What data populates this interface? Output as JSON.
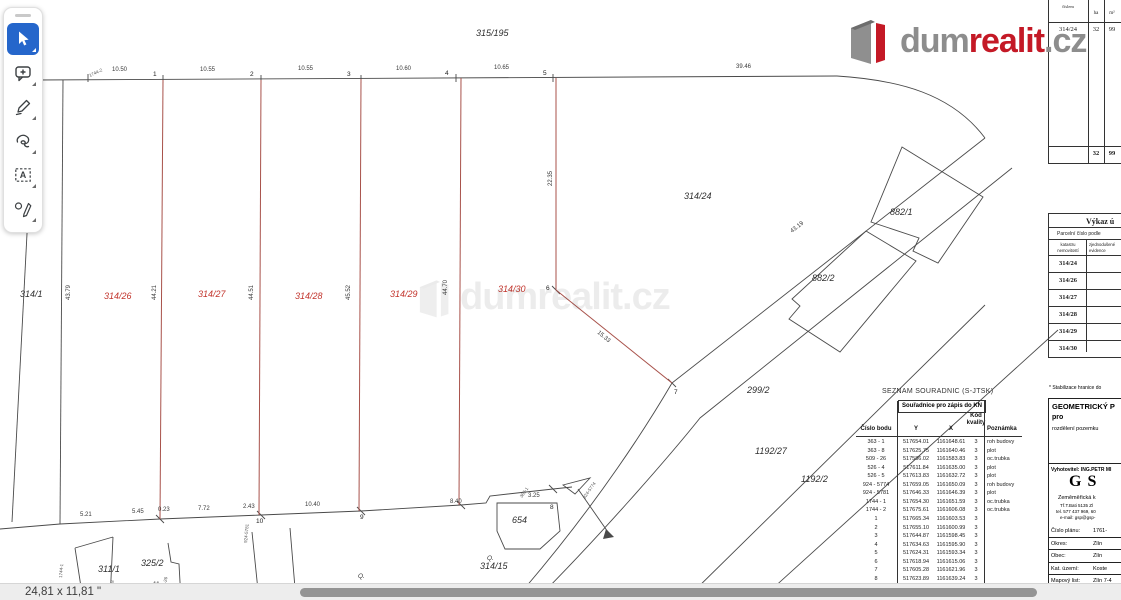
{
  "toolbar": {
    "tools": [
      {
        "name": "select-tool",
        "icon": "cursor-icon",
        "active": true
      },
      {
        "name": "comment-tool",
        "icon": "comment-plus-icon",
        "active": false
      },
      {
        "name": "draw-tool",
        "icon": "pencil-icon",
        "active": false
      },
      {
        "name": "lasso-tool",
        "icon": "lasso-icon",
        "active": false
      },
      {
        "name": "text-box-tool",
        "icon": "text-box-icon",
        "active": false
      },
      {
        "name": "sign-tool",
        "icon": "pen-shapes-icon",
        "active": false
      }
    ]
  },
  "logo": {
    "part1": "dum",
    "part2": "realit",
    "part3": ".cz",
    "gray": "#8d8d8d",
    "red": "#c41926"
  },
  "watermark": {
    "text": "dumrealit.cz"
  },
  "status_bar": {
    "page_size": "24,81 x 11,81 \""
  },
  "area_table": {
    "header": "číslem",
    "col_ha": "ha",
    "col_m2": "m²",
    "row": {
      "parcel": "314/24",
      "ha": "32",
      "m2": "99"
    },
    "total": {
      "ha": "32",
      "m2": "99"
    }
  },
  "vykaz_table": {
    "title": "Výkaz ú",
    "subtitle": "Parcelní číslo podle",
    "col1": [
      "katastru",
      "nemovitostí"
    ],
    "col2": [
      "zjednodušené",
      "evidence"
    ],
    "rows": [
      "314/24",
      "314/26",
      "314/27",
      "314/28",
      "314/29",
      "314/30"
    ]
  },
  "plan_block": {
    "note": "* Stabilizace hranice do",
    "title": "GEOMETRICKÝ P",
    "title2": "pro",
    "subtitle": "rozdělení pozemku",
    "vyhotovitel": "Vyhotovitel: ING.PETR MI",
    "logo": "GS",
    "company": "Zeměměřická k",
    "address": "Tř.T.Bati 5135 Zl",
    "phone": "tel. 577 437 969, 60",
    "email": "e-mail: gsp@gsp-",
    "rows": [
      {
        "label": "Číslo plánu:",
        "value": "1761-"
      },
      {
        "label": "Okres:",
        "value": "Zlín"
      },
      {
        "label": "Obec:",
        "value": "Zlín"
      },
      {
        "label": "Kat. území:",
        "value": "Koste"
      },
      {
        "label": "Mapový list:",
        "value": "Zlín 7-4"
      }
    ],
    "footer": "Dosavadním vlastníkům poze"
  },
  "coord_table": {
    "title": "SEZNAM SOUŘADNIC (S-JTSK)",
    "span_header": "Souřadnice pro zápis do KN",
    "col_point": "Číslo bodu",
    "col_y": "Y",
    "col_x": "X",
    "col_kod": [
      "Kód",
      "kvality"
    ],
    "col_note": "Poznámka",
    "rows": [
      [
        "363 - 1",
        "517654.01",
        "1161648.61",
        "3",
        "roh budovy"
      ],
      [
        "363 - 8",
        "517625.75",
        "1161640.46",
        "3",
        "plot"
      ],
      [
        "509 - 26",
        "517586.02",
        "1161583.83",
        "3",
        "oc.trubka"
      ],
      [
        "526 - 4",
        "517611.84",
        "1161635.00",
        "3",
        "plot"
      ],
      [
        "526 - 5",
        "517613.83",
        "1161632.72",
        "3",
        "plot"
      ],
      [
        "924 - 5774",
        "517659.05",
        "1161650.09",
        "3",
        "roh budovy"
      ],
      [
        "924 - 5781",
        "517646.33",
        "1161646.39",
        "3",
        "plot"
      ],
      [
        "1744 - 1",
        "517654.30",
        "1161651.59",
        "3",
        "oc.trubka"
      ],
      [
        "1744 - 2",
        "517675.61",
        "1161606.08",
        "3",
        "oc.trubka"
      ],
      [
        "1",
        "517665.34",
        "1161603.53",
        "3",
        ""
      ],
      [
        "2",
        "517655.10",
        "1161600.99",
        "3",
        ""
      ],
      [
        "3",
        "517644.87",
        "1161598.45",
        "3",
        ""
      ],
      [
        "4",
        "517634.63",
        "1161595.90",
        "3",
        ""
      ],
      [
        "5",
        "517624.31",
        "1161593.34",
        "3",
        ""
      ],
      [
        "6",
        "517618.94",
        "1161615.06",
        "3",
        ""
      ],
      [
        "7",
        "517605.28",
        "1161621.96",
        "3",
        ""
      ],
      [
        "8",
        "517623.89",
        "1161639.24",
        "3",
        ""
      ],
      [
        "9",
        "517633.87",
        "1161642.79",
        "3",
        ""
      ]
    ]
  },
  "map": {
    "colors": {
      "line": "#4a4a4a",
      "red_line": "#a8514a",
      "red_label": "#c2342c"
    },
    "labels": [
      {
        "t": "315/195",
        "x": 476,
        "y": 36,
        "cls": "pb",
        "n": "parcel-label-315-195"
      },
      {
        "t": "314/1",
        "x": 20,
        "y": 297,
        "cls": "pb",
        "n": "parcel-label-314-1"
      },
      {
        "t": "314/24",
        "x": 684,
        "y": 199,
        "cls": "pb",
        "n": "parcel-label-314-24"
      },
      {
        "t": "882/1",
        "x": 890,
        "y": 215,
        "cls": "pb",
        "n": "parcel-label-882-1"
      },
      {
        "t": "882/2",
        "x": 812,
        "y": 281,
        "cls": "pb",
        "n": "parcel-label-882-2"
      },
      {
        "t": "299/2",
        "x": 747,
        "y": 393,
        "cls": "pb",
        "n": "parcel-label-299-2"
      },
      {
        "t": "1192/27",
        "x": 755,
        "y": 454,
        "cls": "pb",
        "n": "parcel-label-1192-27"
      },
      {
        "t": "1192/2",
        "x": 801,
        "y": 482,
        "cls": "pb",
        "n": "parcel-label-1192-2"
      },
      {
        "t": "654",
        "x": 512,
        "y": 523,
        "cls": "pb",
        "n": "building-label-654"
      },
      {
        "t": "314/15",
        "x": 480,
        "y": 569,
        "cls": "pb",
        "n": "parcel-label-314-15"
      },
      {
        "t": "311/1",
        "x": 98,
        "y": 572,
        "cls": "pb",
        "n": "parcel-label-311-1"
      },
      {
        "t": "325/2",
        "x": 141,
        "y": 566,
        "cls": "pb",
        "n": "parcel-label-325-2"
      },
      {
        "t": "314/26",
        "x": 104,
        "y": 299,
        "cls": "pr",
        "n": "new-parcel-label-314-26"
      },
      {
        "t": "314/27",
        "x": 198,
        "y": 297,
        "cls": "pr",
        "n": "new-parcel-label-314-27"
      },
      {
        "t": "314/28",
        "x": 295,
        "y": 299,
        "cls": "pr",
        "n": "new-parcel-label-314-28"
      },
      {
        "t": "314/29",
        "x": 390,
        "y": 297,
        "cls": "pr",
        "n": "new-parcel-label-314-29"
      },
      {
        "t": "314/30",
        "x": 498,
        "y": 292,
        "cls": "pr",
        "n": "new-parcel-label-314-30"
      },
      {
        "t": "1",
        "x": 153,
        "y": 76,
        "cls": "pt",
        "n": "point-label-1"
      },
      {
        "t": "2",
        "x": 250,
        "y": 76,
        "cls": "pt",
        "n": "point-label-2"
      },
      {
        "t": "3",
        "x": 347,
        "y": 76,
        "cls": "pt",
        "n": "point-label-3"
      },
      {
        "t": "4",
        "x": 445,
        "y": 75,
        "cls": "pt",
        "n": "point-label-4"
      },
      {
        "t": "5",
        "x": 543,
        "y": 75,
        "cls": "pt",
        "n": "point-label-5"
      },
      {
        "t": "6",
        "x": 546,
        "y": 290,
        "cls": "pt",
        "n": "point-label-6"
      },
      {
        "t": "7",
        "x": 674,
        "y": 394,
        "cls": "pt",
        "n": "point-label-7"
      },
      {
        "t": "8",
        "x": 550,
        "y": 509,
        "cls": "pt",
        "n": "point-label-8"
      },
      {
        "t": "9",
        "x": 360,
        "y": 519,
        "cls": "pt",
        "n": "point-label-9"
      },
      {
        "t": "10",
        "x": 256,
        "y": 523,
        "cls": "pt",
        "n": "point-label-10"
      },
      {
        "t": "11",
        "x": 153,
        "y": 586,
        "cls": "pt",
        "n": "point-label-11"
      },
      {
        "t": "10.50",
        "x": 112,
        "y": 71,
        "cls": "dm",
        "n": "dimension-label"
      },
      {
        "t": "10.55",
        "x": 200,
        "y": 71,
        "cls": "dm",
        "n": "dimension-label"
      },
      {
        "t": "10.55",
        "x": 298,
        "y": 70,
        "cls": "dm",
        "n": "dimension-label"
      },
      {
        "t": "10.60",
        "x": 396,
        "y": 70,
        "cls": "dm",
        "n": "dimension-label"
      },
      {
        "t": "10.65",
        "x": 494,
        "y": 69,
        "cls": "dm",
        "n": "dimension-label"
      },
      {
        "t": "39.46",
        "x": 736,
        "y": 68,
        "cls": "dm",
        "n": "dimension-label"
      },
      {
        "t": "5.21",
        "x": 80,
        "y": 516,
        "cls": "dm",
        "n": "dimension-label"
      },
      {
        "t": "5.45",
        "x": 132,
        "y": 513,
        "cls": "dm",
        "n": "dimension-label"
      },
      {
        "t": "0.23",
        "x": 158,
        "y": 511,
        "cls": "dm",
        "n": "dimension-label"
      },
      {
        "t": "7.72",
        "x": 198,
        "y": 510,
        "cls": "dm",
        "n": "dimension-label"
      },
      {
        "t": "2.43",
        "x": 243,
        "y": 508,
        "cls": "dm",
        "n": "dimension-label"
      },
      {
        "t": "10.40",
        "x": 305,
        "y": 506,
        "cls": "dm",
        "n": "dimension-label"
      },
      {
        "t": "8.40",
        "x": 450,
        "y": 503,
        "cls": "dm",
        "n": "dimension-label"
      },
      {
        "t": "3.25",
        "x": 528,
        "y": 497,
        "cls": "dm",
        "n": "dimension-label"
      },
      {
        "t": "43.79",
        "x": 70,
        "y": 300,
        "r": -90,
        "cls": "dm",
        "n": "dimension-label"
      },
      {
        "t": "44.21",
        "x": 156,
        "y": 300,
        "r": -90,
        "cls": "dm",
        "n": "dimension-label"
      },
      {
        "t": "44.51",
        "x": 253,
        "y": 300,
        "r": -90,
        "cls": "dm",
        "n": "dimension-label"
      },
      {
        "t": "45.52",
        "x": 350,
        "y": 300,
        "r": -90,
        "cls": "dm",
        "n": "dimension-label"
      },
      {
        "t": "44.70",
        "x": 447,
        "y": 295,
        "r": -90,
        "cls": "dm",
        "n": "dimension-label"
      },
      {
        "t": "22.35",
        "x": 552,
        "y": 186,
        "r": -90,
        "cls": "dm",
        "n": "dimension-label"
      },
      {
        "t": "15.33",
        "x": 597,
        "y": 333,
        "r": 40,
        "cls": "dm",
        "n": "dimension-label"
      },
      {
        "t": "43.19",
        "x": 792,
        "y": 233,
        "r": -38,
        "cls": "dm",
        "n": "dimension-label"
      },
      {
        "t": "1744-2",
        "x": 90,
        "y": 77,
        "r": -25,
        "cls": "tid",
        "n": "point-id-label"
      },
      {
        "t": "1744-1",
        "x": 62,
        "y": 578,
        "r": -85,
        "cls": "tid",
        "n": "point-id-label"
      },
      {
        "t": "363-8",
        "x": 113,
        "y": 592,
        "r": -85,
        "cls": "tid",
        "n": "point-id-label"
      },
      {
        "t": "509-26",
        "x": 165,
        "y": 591,
        "r": -80,
        "cls": "tid",
        "n": "point-id-label"
      },
      {
        "t": "924-5781",
        "x": 247,
        "y": 543,
        "r": -85,
        "cls": "tid",
        "n": "point-id-label"
      },
      {
        "t": "363-1",
        "x": 522,
        "y": 498,
        "r": -55,
        "cls": "tid",
        "n": "point-id-label"
      },
      {
        "t": "924-5774",
        "x": 585,
        "y": 499,
        "r": -55,
        "cls": "tid",
        "n": "point-id-label"
      },
      {
        "t": "Q.",
        "x": 358,
        "y": 578,
        "cls": "sym",
        "n": "orchard-symbol"
      },
      {
        "t": "Q.",
        "x": 487,
        "y": 560,
        "cls": "sym",
        "n": "orchard-symbol"
      }
    ]
  }
}
